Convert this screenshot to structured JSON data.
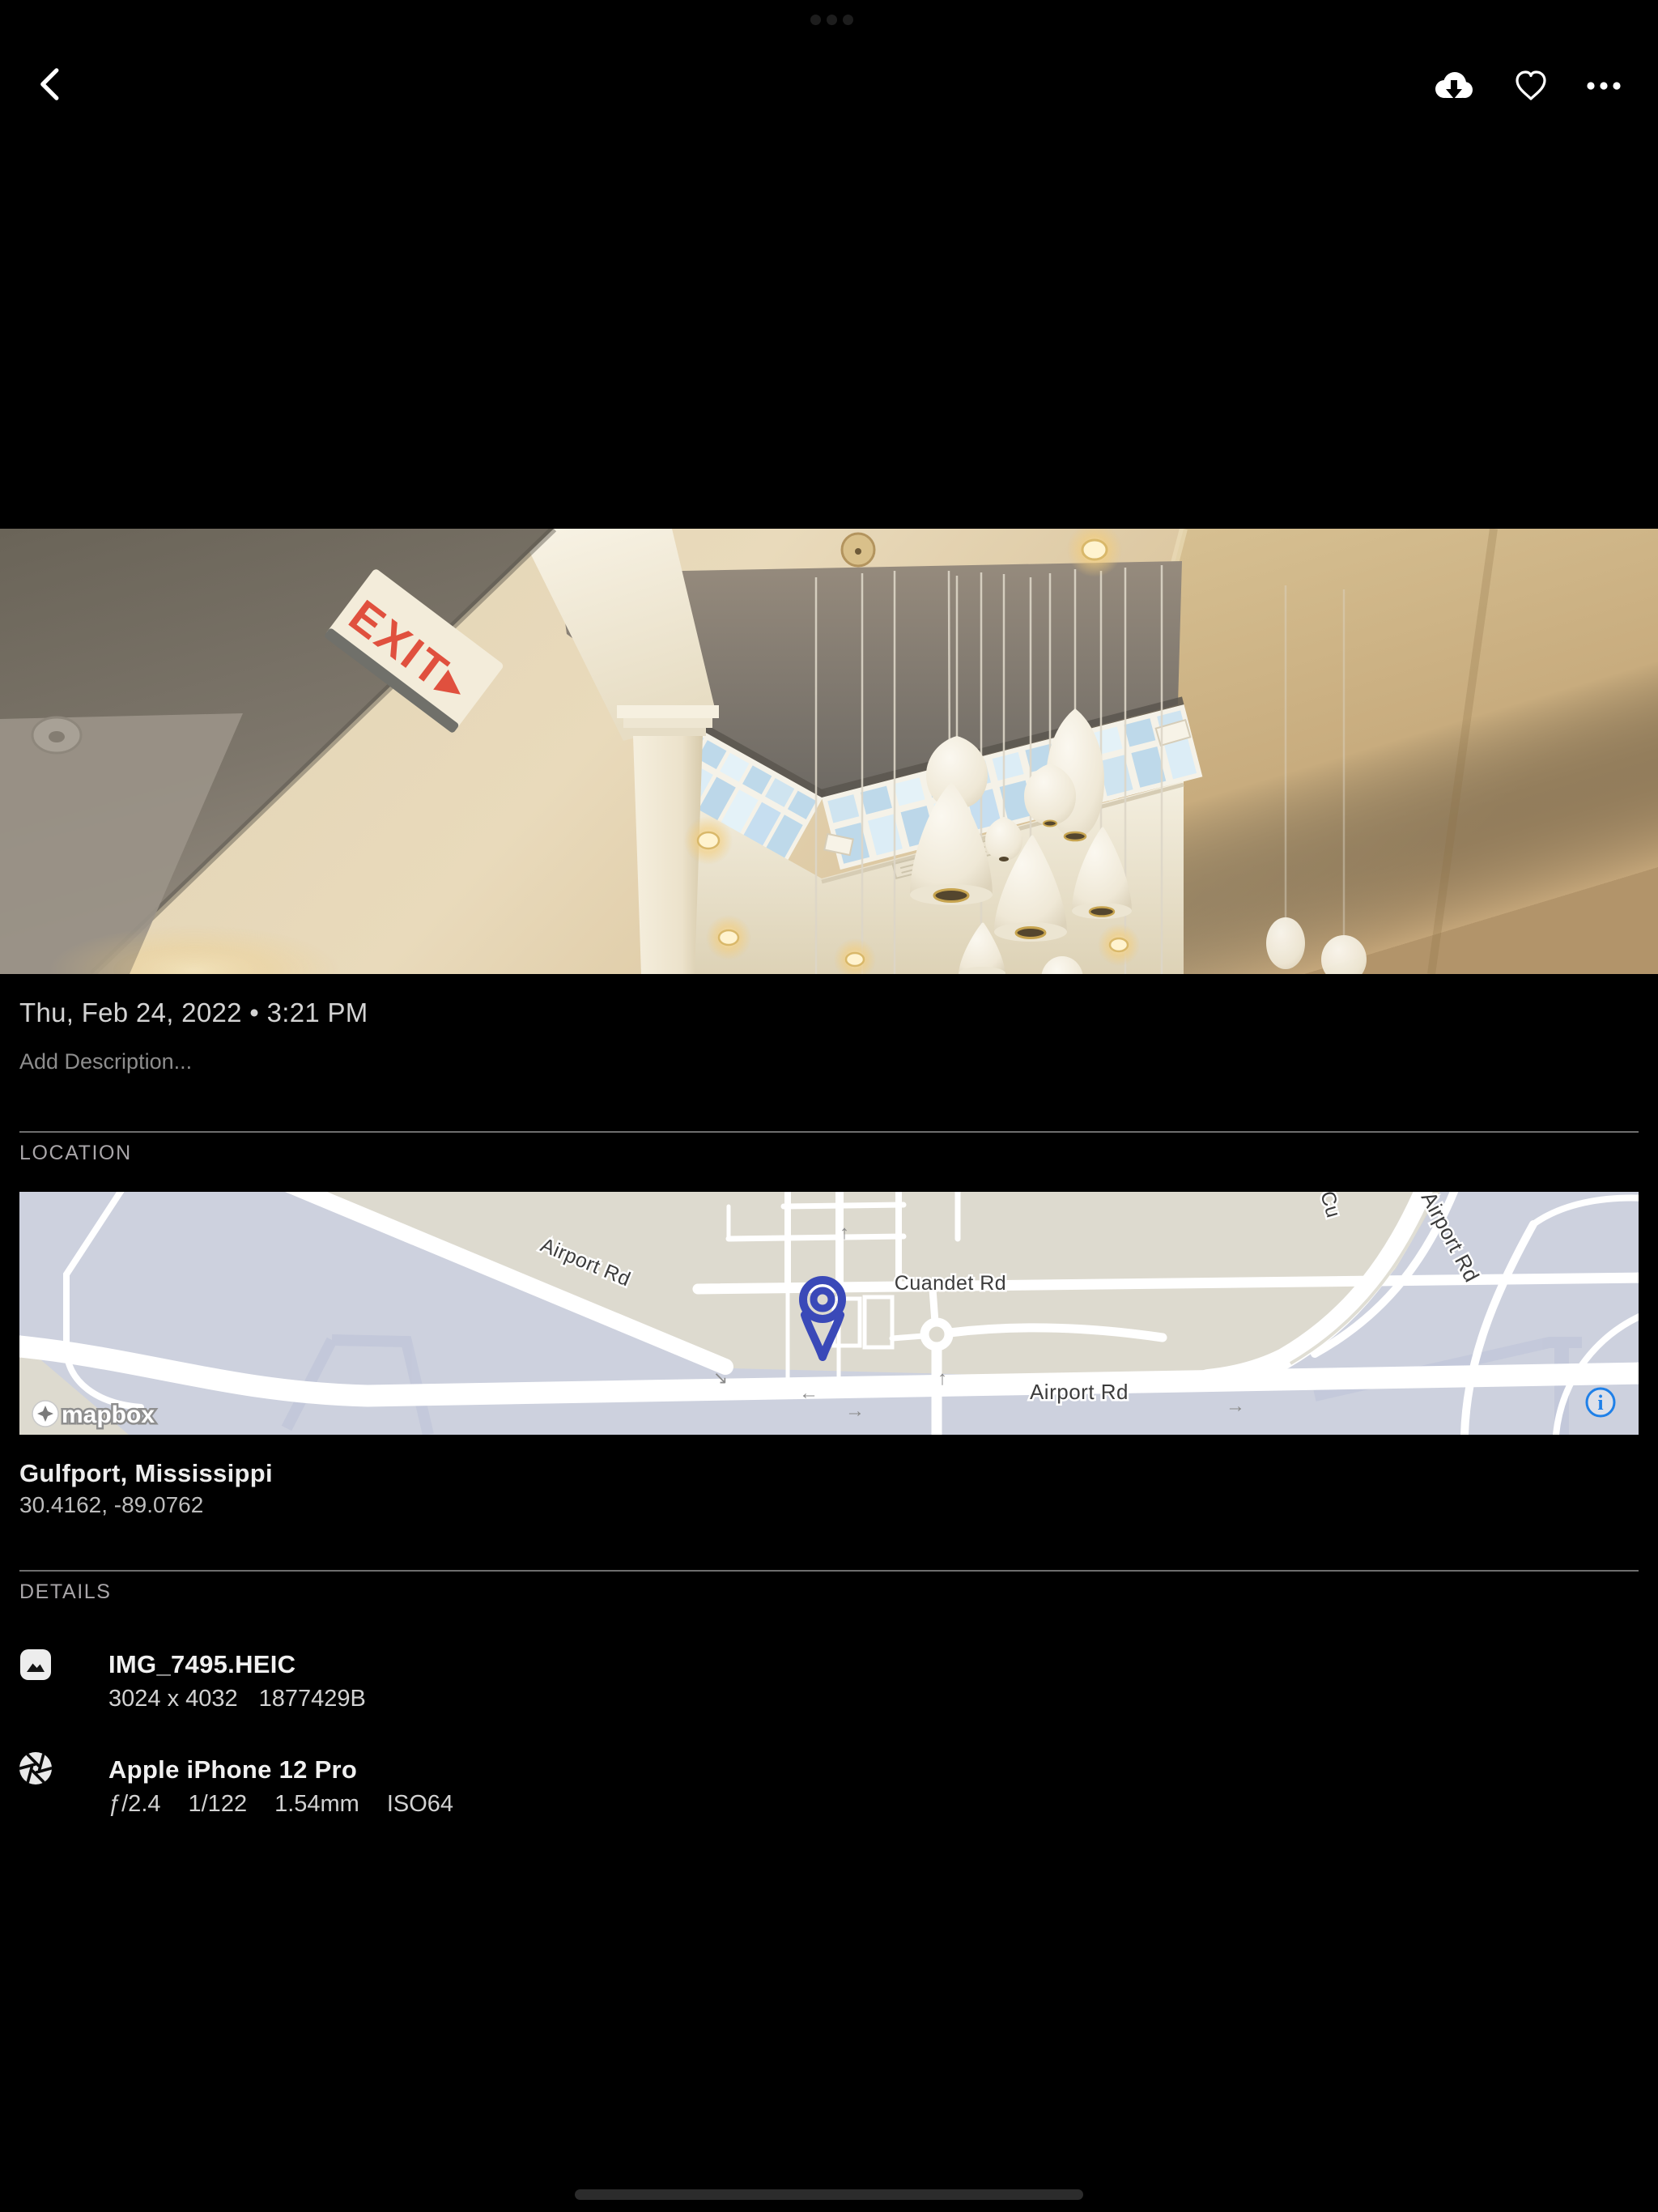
{
  "colors": {
    "accent_blue": "#1f80e8",
    "pin_indigo": "#3a49b8",
    "exit_red": "#e0503e",
    "map_land": "#dddacf",
    "map_base": "#cdd1de"
  },
  "top_bar": {
    "back_icon": "chevron-left",
    "download_icon": "cloud-download",
    "favorite_icon": "heart-outline",
    "more_icon": "ellipsis-horizontal"
  },
  "photo": {
    "exit_sign_text": "EXIT▸"
  },
  "meta": {
    "datetime": "Thu, Feb 24, 2022 • 3:21 PM",
    "description_placeholder": "Add Description..."
  },
  "location": {
    "header": "LOCATION",
    "place": "Gulfport, Mississippi",
    "coordinates": "30.4162, -89.0762",
    "map": {
      "label_airport_rd_diagonal": "Airport Rd",
      "label_cuandet_rd": "Cuandet Rd",
      "label_airport_rd_horizontal": "Airport Rd",
      "label_airport_rd_curve": "Airport Rd",
      "label_cuandet_fragment": "Cu",
      "arrow_left": "←",
      "arrow_right": "→",
      "arrow_up": "↑",
      "arrow_diag": "↘",
      "attribution": "mapbox",
      "info_glyph": "i"
    }
  },
  "details": {
    "header": "DETAILS",
    "file": {
      "icon": "image",
      "name": "IMG_7495.HEIC",
      "dimensions": "3024 x 4032",
      "size": "1877429B"
    },
    "camera": {
      "icon": "aperture",
      "name": "Apple iPhone 12 Pro",
      "aperture": "ƒ/2.4",
      "shutter": "1/122",
      "focal_length": "1.54mm",
      "iso": "ISO64"
    }
  }
}
